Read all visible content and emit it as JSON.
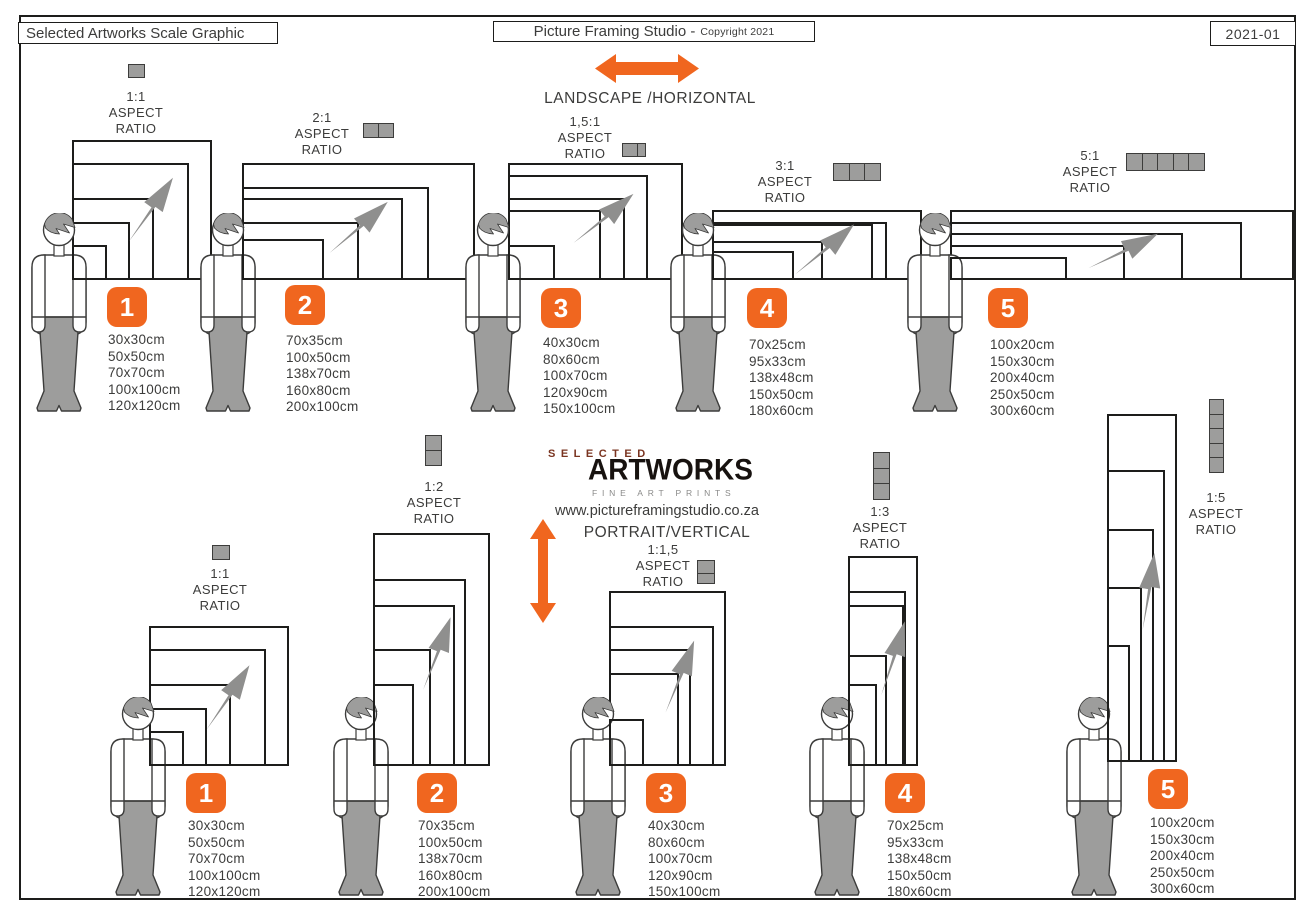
{
  "header": {
    "left_title": "Selected Artworks Scale Graphic",
    "studio_title": "Picture Framing Studio -",
    "copyright": "Copyright 2021",
    "doc_code": "2021-01"
  },
  "orientation": {
    "landscape": "LANDSCAPE /HORIZONTAL",
    "portrait": "PORTRAIT/VERTICAL"
  },
  "labels": {
    "aspect": "ASPECT",
    "ratio": "RATIO"
  },
  "logo": {
    "top": "SELECTED",
    "main": "ARTWORKS",
    "sub": "FINE ART PRINTS"
  },
  "website": "www.pictureframingstudio.co.za",
  "landscape_groups": [
    {
      "number": "1",
      "ratio": "1:1",
      "icon": "1-square-horizontal",
      "sizes": [
        "30x30cm",
        "50x50cm",
        "70x70cm",
        "100x100cm",
        "120x120cm"
      ]
    },
    {
      "number": "2",
      "ratio": "2:1",
      "icon": "2-squares-horizontal",
      "sizes": [
        "70x35cm",
        "100x50cm",
        "138x70cm",
        "160x80cm",
        "200x100cm"
      ]
    },
    {
      "number": "3",
      "ratio": "1,5:1",
      "icon": "1.5-squares-horizontal",
      "sizes": [
        "40x30cm",
        "80x60cm",
        "100x70cm",
        "120x90cm",
        "150x100cm"
      ]
    },
    {
      "number": "4",
      "ratio": "3:1",
      "icon": "3-squares-horizontal",
      "sizes": [
        "70x25cm",
        "95x33cm",
        "138x48cm",
        "150x50cm",
        "180x60cm"
      ]
    },
    {
      "number": "5",
      "ratio": "5:1",
      "icon": "5-squares-horizontal",
      "sizes": [
        "100x20cm",
        "150x30cm",
        "200x40cm",
        "250x50cm",
        "300x60cm"
      ]
    }
  ],
  "portrait_groups": [
    {
      "number": "1",
      "ratio": "1:1",
      "icon": "1-square-vertical",
      "sizes": [
        "30x30cm",
        "50x50cm",
        "70x70cm",
        "100x100cm",
        "120x120cm"
      ]
    },
    {
      "number": "2",
      "ratio": "1:2",
      "icon": "2-squares-vertical",
      "sizes": [
        "70x35cm",
        "100x50cm",
        "138x70cm",
        "160x80cm",
        "200x100cm"
      ]
    },
    {
      "number": "3",
      "ratio": "1:1,5",
      "icon": "1.5-squares-vertical",
      "sizes": [
        "40x30cm",
        "80x60cm",
        "100x70cm",
        "120x90cm",
        "150x100cm"
      ]
    },
    {
      "number": "4",
      "ratio": "1:3",
      "icon": "3-squares-vertical",
      "sizes": [
        "70x25cm",
        "95x33cm",
        "138x48cm",
        "150x50cm",
        "180x60cm"
      ]
    },
    {
      "number": "5",
      "ratio": "1:5",
      "icon": "5-squares-vertical",
      "sizes": [
        "100x20cm",
        "150x30cm",
        "200x40cm",
        "250x50cm",
        "300x60cm"
      ]
    }
  ],
  "colors": {
    "accent_orange": "#F0661F",
    "mid_gray": "#9D9D9C",
    "arrow_gray": "#8F8F8E",
    "dark_text": "#3C3C3B",
    "line_black": "#1D1D1B",
    "logo_brown": "#7A3420"
  }
}
